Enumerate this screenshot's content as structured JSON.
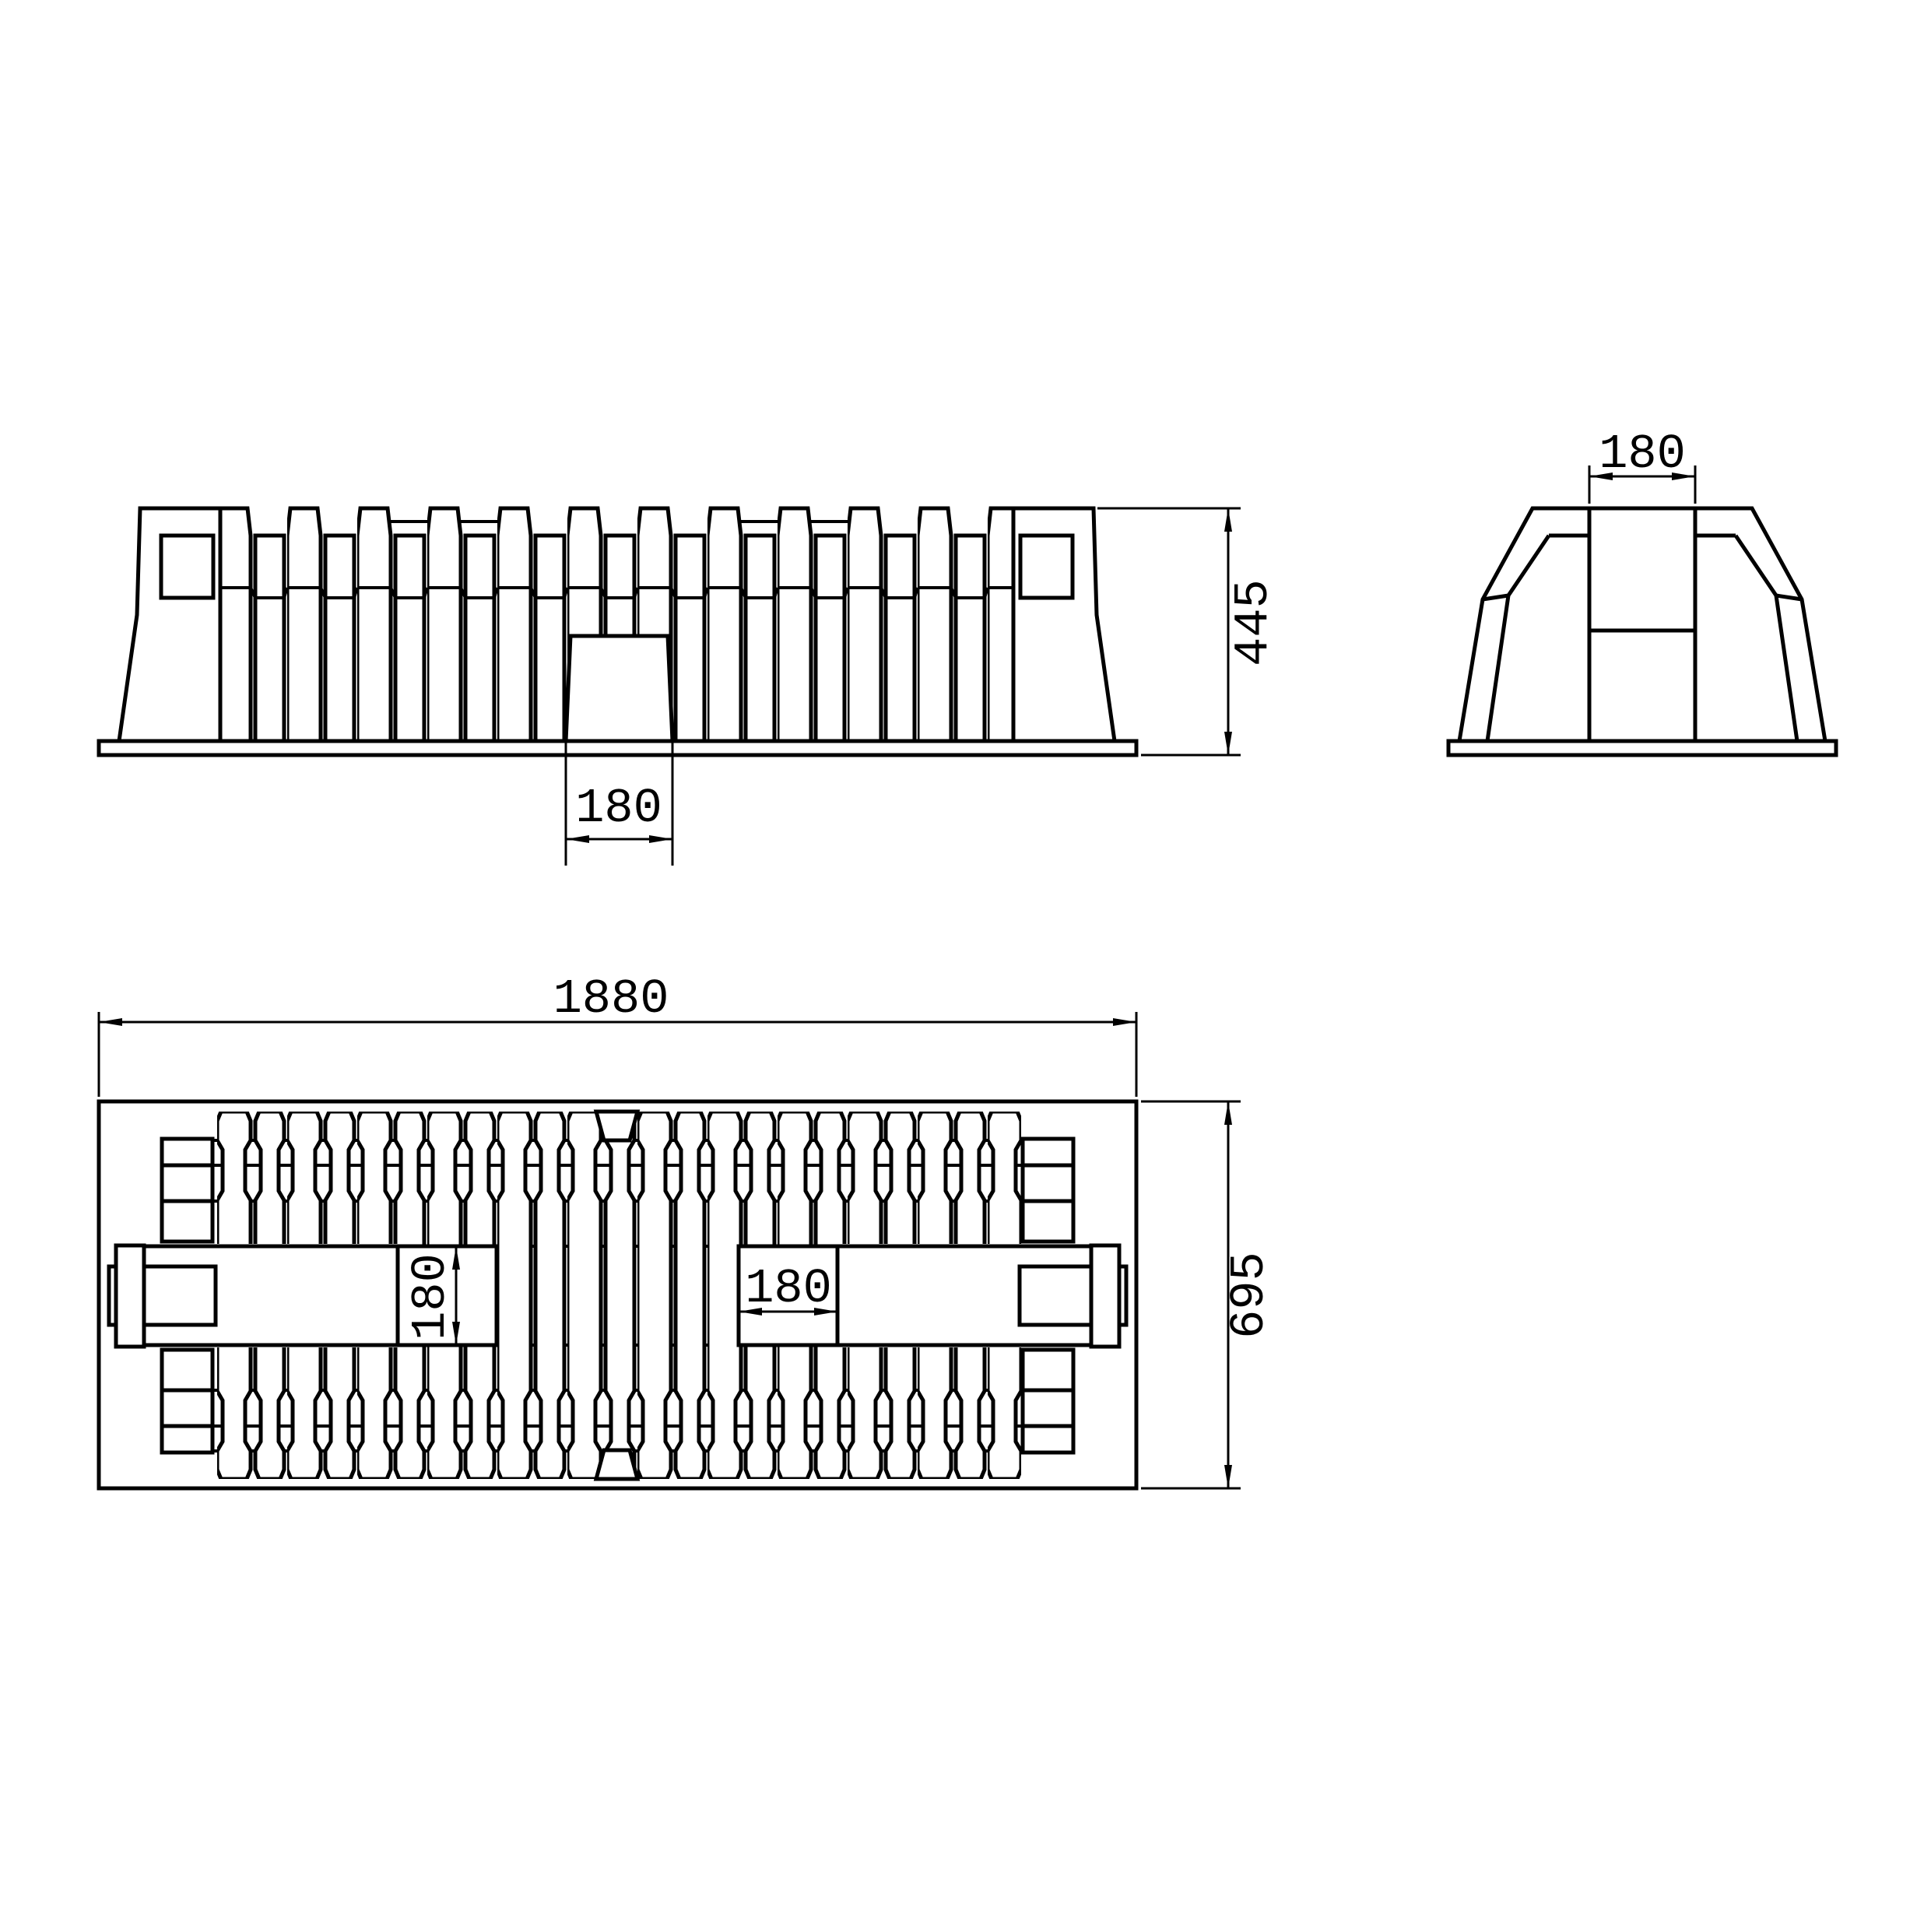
{
  "drawing": {
    "type": "engineering-orthographic-views",
    "background_color": "#ffffff",
    "line_color": "#000000",
    "views": {
      "front_elevation": {
        "description": "front elevation of finned block with base plate and central channel",
        "height_dim": "445",
        "channel_width_dim": "180"
      },
      "end_view": {
        "description": "end elevation, trapezoidal body with central channel",
        "channel_width_dim": "180"
      },
      "plan_view": {
        "description": "plan view with transverse ribs, two pockets and end lugs",
        "length_dim": "1880",
        "width_dim": "695",
        "pocket_height_dim": "180",
        "pocket_width_dim": "180"
      }
    }
  }
}
